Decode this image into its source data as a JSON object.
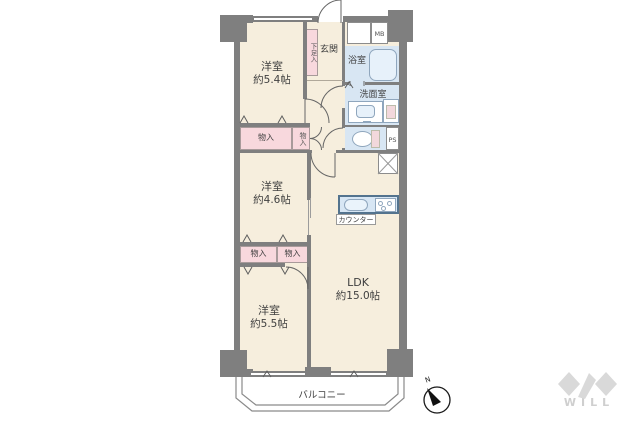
{
  "floorplan": {
    "bedroom1": {
      "name": "洋室",
      "size": "約5.4帖"
    },
    "bedroom2": {
      "name": "洋室",
      "size": "約4.6帖"
    },
    "bedroom3": {
      "name": "洋室",
      "size": "約5.5帖"
    },
    "ldk": {
      "name": "LDK",
      "size": "約15.0帖"
    },
    "entrance": "玄関",
    "shoe_closet": "下足入",
    "bathroom": "浴室",
    "washroom": "洗面室",
    "closet1": "物入",
    "closet2": "物入",
    "closet3": "物入",
    "closet4": "物入",
    "meter_box": "MB",
    "pipe_space": "PS",
    "counter": "カウンター",
    "balcony": "バルコニー",
    "compass_north": "N"
  },
  "branding": {
    "logo": "WILL"
  },
  "colors": {
    "wall": "#7f7f7f",
    "room_fill": "#f6eedd",
    "closet_fill": "#f8d8dd",
    "wet_area_fill": "#d8e6f3",
    "counter_border": "#53738e",
    "logo_gray": "#d9d9d9"
  }
}
